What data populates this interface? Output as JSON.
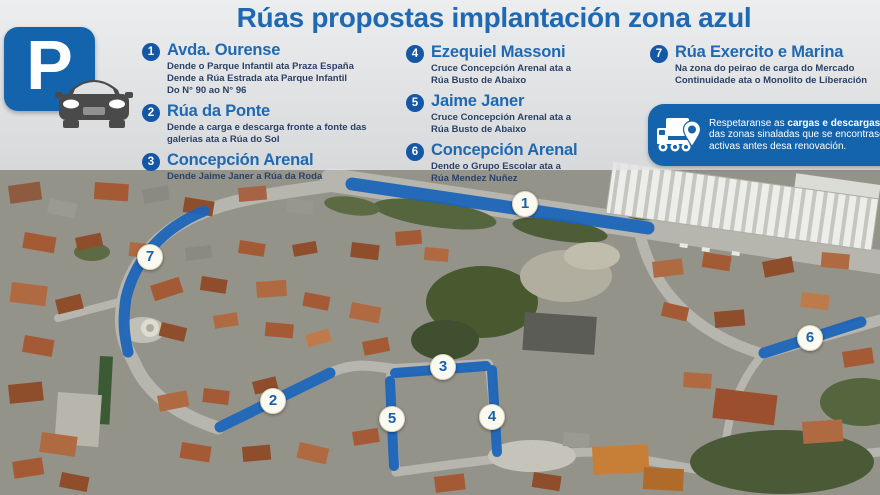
{
  "title": "Rúas propostas implantación zona azul",
  "parking_badge": {
    "letter": "P"
  },
  "legend": {
    "columns": [
      {
        "items": [
          {
            "num": "1",
            "name": "Avda. Ourense",
            "desc": "Dende o Parque Infantil ata Praza España\nDende a Rúa Estrada ata Parque Infantil\nDo N° 90 ao N° 96"
          },
          {
            "num": "2",
            "name": "Rúa da Ponte",
            "desc": "Dende a carga e descarga fronte a fonte das\ngalerias ata a Rúa do Sol"
          },
          {
            "num": "3",
            "name": "Concepción Arenal",
            "desc": "Dende Jaime Janer a Rúa da Roda"
          }
        ]
      },
      {
        "items": [
          {
            "num": "4",
            "name": "Ezequiel Massoni",
            "desc": "Cruce Concepción Arenal ata a\nRúa Busto de Abaixo"
          },
          {
            "num": "5",
            "name": "Jaime Janer",
            "desc": "Cruce Concepción Arenal ata a\nRúa Busto de Abaixo"
          },
          {
            "num": "6",
            "name": "Concepción Arenal",
            "desc": "Dende o Grupo Escolar ata a\nRúa Mendez Nuñez"
          }
        ]
      },
      {
        "items": [
          {
            "num": "7",
            "name": "Rúa Exercito e Marina",
            "desc": "Na zona do peirao de carga do Mercado\nContinuidade ata o Monolito de Liberación"
          }
        ]
      }
    ]
  },
  "note": {
    "text_1": "Respetaranse as ",
    "text_bold": "cargas e descargas",
    "text_2": " das zonas sinaladas que se encontrasen activas antes desa renovación."
  },
  "map": {
    "markers": [
      {
        "label": "1"
      },
      {
        "label": "2"
      },
      {
        "label": "3"
      },
      {
        "label": "4"
      },
      {
        "label": "5"
      },
      {
        "label": "6"
      },
      {
        "label": "7"
      }
    ]
  },
  "colors": {
    "accent_blue": "#1464ad",
    "title_blue": "#1e69b2",
    "route_blue": "#1a64ba",
    "badge_blue": "#1457a6",
    "description_navy": "#2b4168"
  }
}
